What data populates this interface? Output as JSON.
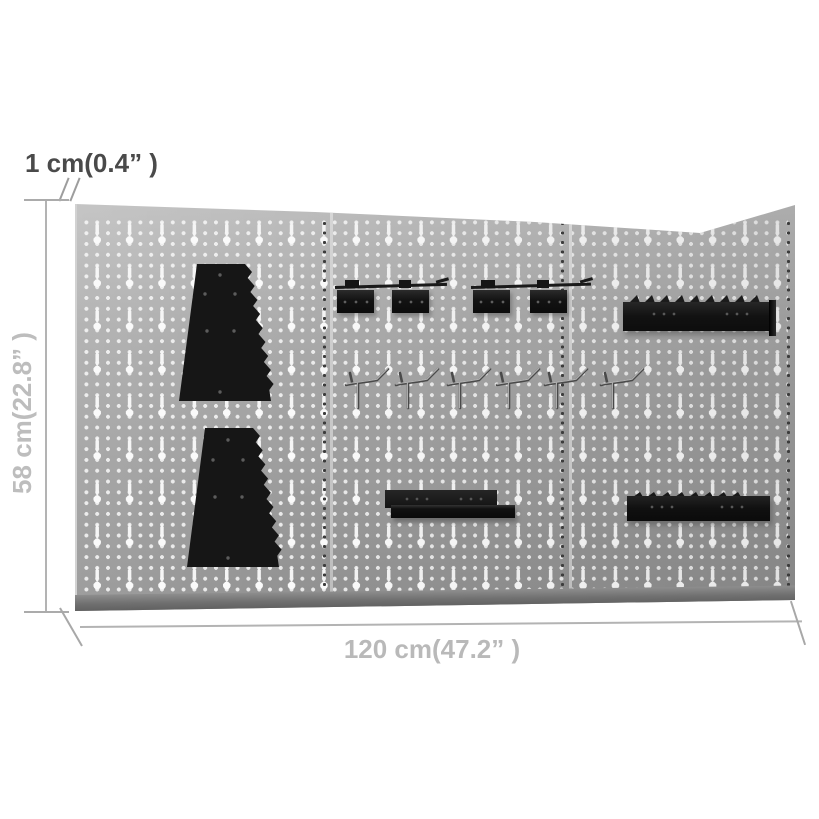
{
  "meta": {
    "description": "Dimension diagram of three wall-mounted grey pegboard panels with black tool-holder accessories"
  },
  "dimensions": {
    "thickness_label": "1 cm(0.4” )",
    "height_label": "58 cm(22.8” )",
    "width_label": "120 cm(47.2” )"
  },
  "board": {
    "panel_count": 3,
    "accessories": [
      {
        "name": "serrated-tool-rack-upper",
        "panel": 1
      },
      {
        "name": "serrated-tool-rack-lower",
        "panel": 1
      },
      {
        "name": "tool-clip-rail-left",
        "panel": 2
      },
      {
        "name": "tool-clip-rail-right",
        "panel": 2
      },
      {
        "name": "peg-hook-row",
        "panels": "2-3",
        "count": 6
      },
      {
        "name": "shelf-bracket",
        "panel": 2
      },
      {
        "name": "serrated-rail",
        "panel": 3
      },
      {
        "name": "serrated-shelf",
        "panel": 3
      }
    ]
  },
  "colors": {
    "background": "#ffffff",
    "panel_grey": "#a5a5a5",
    "panel_edge_dark": "#636363",
    "hole_white": "#f7f7f7",
    "accessory_black": "#171717",
    "dim_text_dark": "#4a4a4a",
    "dim_text_light": "#bdbdbd",
    "dim_line": "#b3b3b3"
  }
}
